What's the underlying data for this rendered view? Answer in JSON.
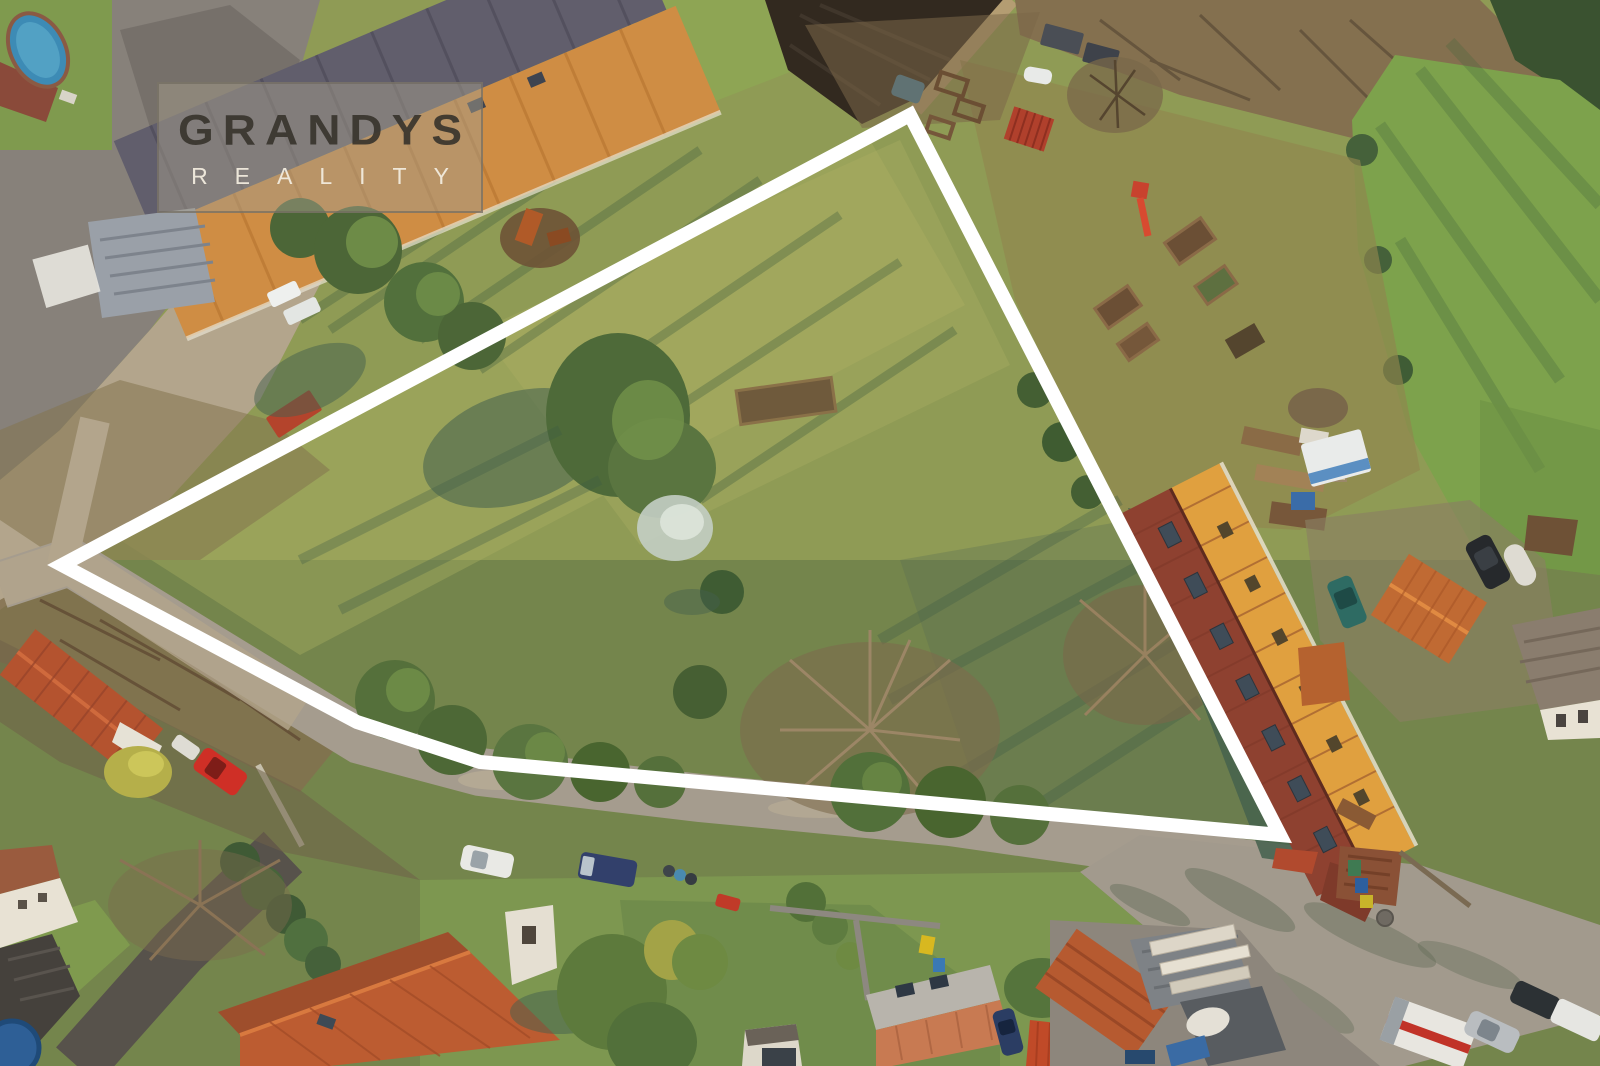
{
  "watermark": {
    "title": "GRANDYS",
    "subtitle": "REALITY",
    "title_color": "#37332c",
    "subtitle_color": "#f2ecdf",
    "box_fill": "rgba(164,156,138,0.5)",
    "box_border": "rgba(110,104,94,0.65)"
  },
  "plot": {
    "outline_points": "910,115 1280,835 480,762 357,722 62,565",
    "outline_color": "#ffffff",
    "outline_width": "14"
  },
  "scene": {
    "description": "Top-down aerial drone photo of a village building plot outlined in white, with farm barn at top left, gardens at right, long orange-roofed building, roads and houses along the bottom"
  },
  "palette": {
    "grass_base": "#8f9b55",
    "grass_bright": "#aab061",
    "grass_lawn": "#74854c",
    "field_green": "#7da24c",
    "plow_dark": "#32291f",
    "road": "#a59c8e",
    "dirt": "#b3a58c",
    "mud": "#87817a",
    "drive_dark": "#57524b",
    "barn_slate": "#615e6c",
    "barn_orange": "#cf8d44",
    "bldg_dark_red": "#8e4130",
    "bldg_orange": "#e0a03f",
    "tile_red": "#b4532f",
    "salmon_roof": "#c87a52",
    "shadow_green": "#44604e",
    "tree_dark": "#4c6637",
    "tree_light": "#76954b",
    "brush_brown": "#83704f",
    "pale_tree": "#c3cec4",
    "pool_blue": "#3d8bb5",
    "car_red": "#cf2f26",
    "white_line": "#ffffff"
  }
}
